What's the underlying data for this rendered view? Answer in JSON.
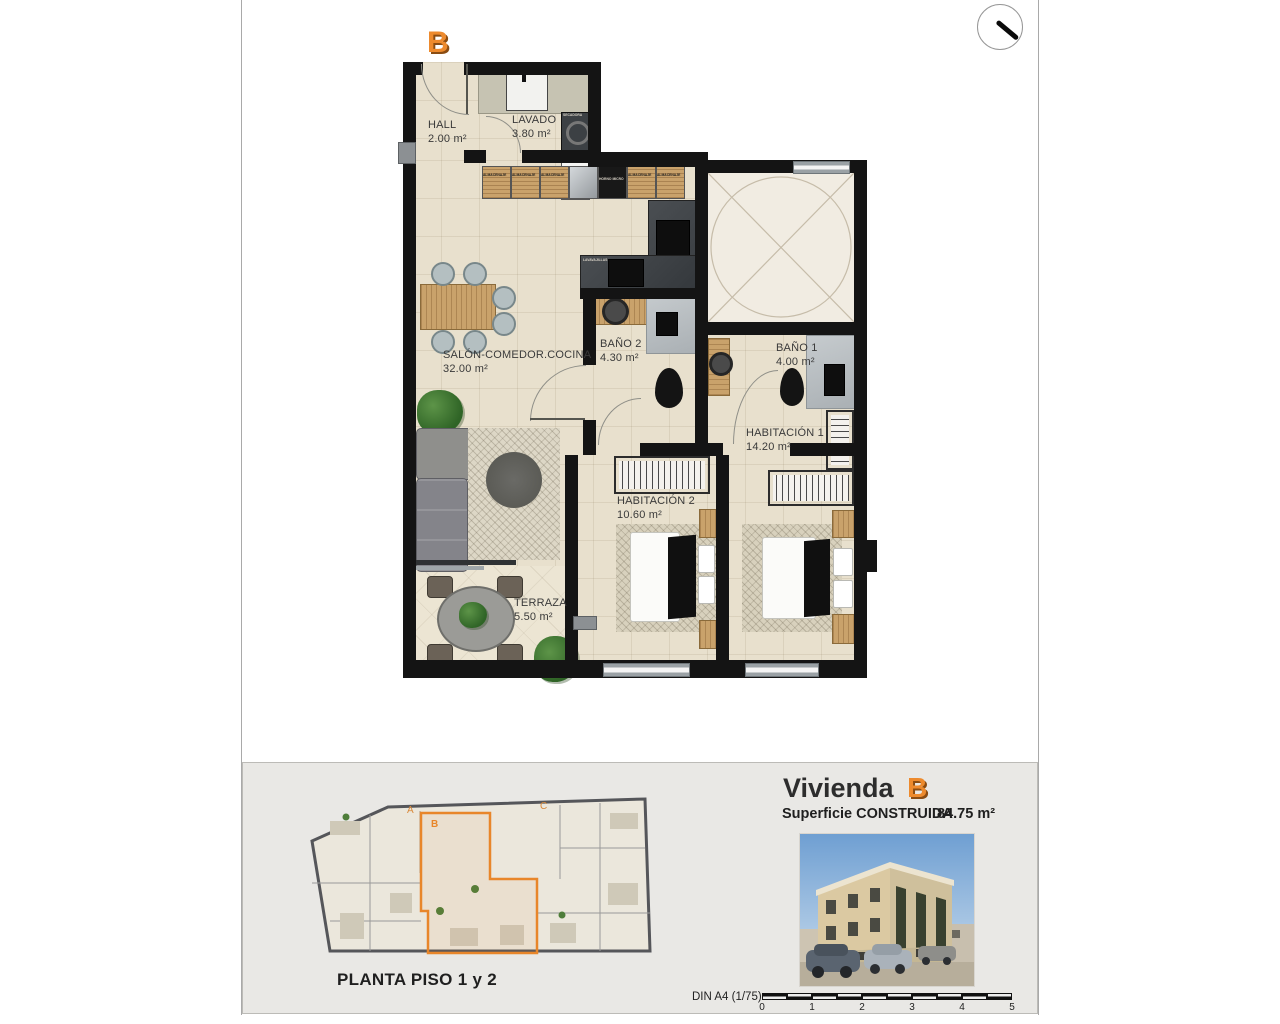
{
  "plan": {
    "unit_letter": "B",
    "rooms": [
      {
        "name": "HALL",
        "area": "2.00 m²"
      },
      {
        "name": "LAVADO",
        "area": "3.80 m²"
      },
      {
        "name": "SALÓN-COMEDOR.COCINA",
        "area": "32.00 m²"
      },
      {
        "name": "BAÑO 2",
        "area": "4.30 m²"
      },
      {
        "name": "BAÑO 1",
        "area": "4.00 m²"
      },
      {
        "name": "HABITACIÓN 1",
        "area": "14.20 m²"
      },
      {
        "name": "HABITACIÓN 2",
        "area": "10.60 m²"
      },
      {
        "name": "TERRAZA",
        "area": "5.50 m²"
      }
    ],
    "kitchen_labels": {
      "cabinet": "ALMACENAJE",
      "oven": "HORNO MICRO",
      "dishwasher": "LAVAVAJILLAS",
      "washer": "LAVADORA",
      "dryer": "SECADORA"
    }
  },
  "footer": {
    "plan_caption": "PLANTA PISO 1 y 2",
    "unit_title_prefix": "Vivienda",
    "unit_title_letter": "B",
    "surface_label": "Superficie CONSTRUIDA",
    "surface_value": "84.75 m²",
    "scale_note": "DIN A4 (1/75)",
    "scale_ticks": [
      "0",
      "1",
      "2",
      "3",
      "4",
      "5"
    ],
    "mini_plan_unit_letters": [
      "A",
      "B",
      "C"
    ]
  },
  "colors": {
    "accent": "#ed8a2d",
    "wall": "#141414",
    "floor": "#e8e0cd",
    "patio_floor": "#f1ece2",
    "panel": "#e9e8e5"
  }
}
